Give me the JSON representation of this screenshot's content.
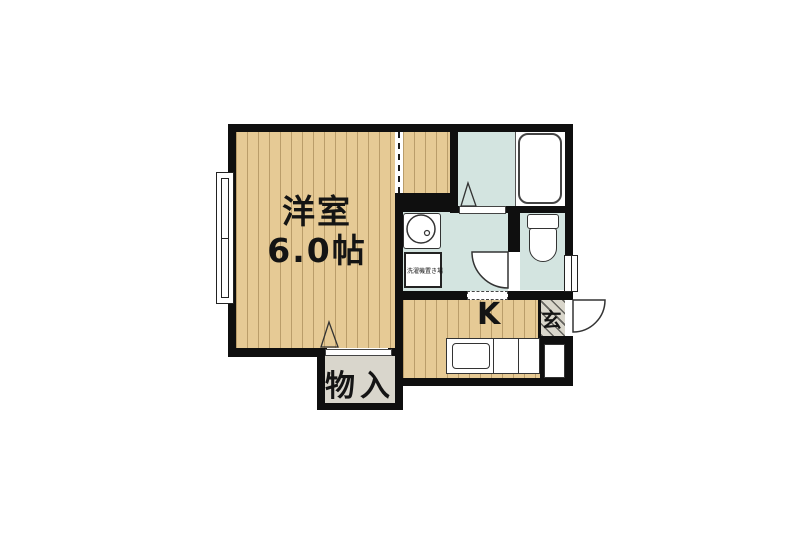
{
  "plan": {
    "type": "apartment-floor-plan",
    "labels": {
      "main_room_name": "洋室",
      "main_room_size": "6.0帖",
      "kitchen": "K",
      "entrance": "玄",
      "storage": "物入",
      "laundry_space": "洗濯機置き場"
    },
    "rooms": [
      {
        "name": "western-room",
        "label": "洋室 6.0帖",
        "floor": "wood"
      },
      {
        "name": "kitchen",
        "label": "K",
        "floor": "wood"
      },
      {
        "name": "bathroom",
        "label": "",
        "floor": "wet",
        "fixture": "bathtub"
      },
      {
        "name": "washroom",
        "label": "洗濯機置き場",
        "floor": "wet",
        "fixtures": [
          "wash-basin",
          "washing-machine-space"
        ]
      },
      {
        "name": "toilet",
        "label": "",
        "floor": "wet",
        "fixture": "toilet"
      },
      {
        "name": "entrance",
        "label": "玄",
        "floor": "tile"
      },
      {
        "name": "storage",
        "label": "物入",
        "floor": "gray"
      }
    ],
    "colors": {
      "wall": "#0f0f0f",
      "wood_floor": "#e6ca95",
      "wet_area": "#d3e4e0",
      "tile": "#d9d6cb",
      "fixture_outline": "#333333"
    }
  }
}
